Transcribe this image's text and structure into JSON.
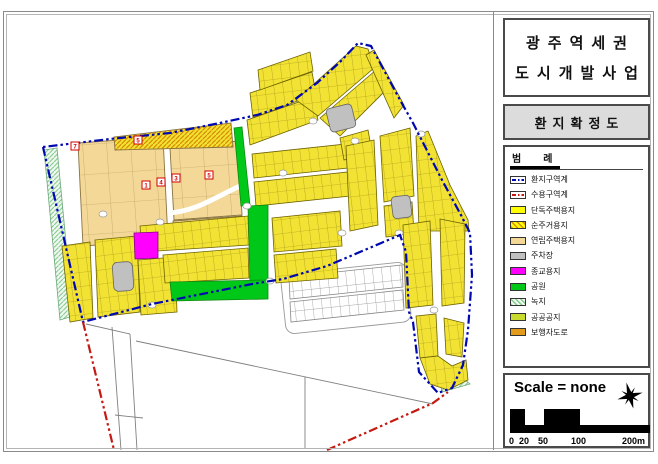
{
  "title_block": {
    "line1": "광주역세권",
    "line2": "도시개발사업"
  },
  "subtitle_block": {
    "label": "환지확정도"
  },
  "legend": {
    "title": "범례",
    "items": [
      {
        "label": "환지구역계",
        "type": "boundary-blue-dashdot"
      },
      {
        "label": "수용구역계",
        "type": "boundary-red-dashdot"
      },
      {
        "label": "단독주택용지",
        "type": "solid-yellow"
      },
      {
        "label": "순주거용지",
        "type": "yellow-orange-hatch"
      },
      {
        "label": "연립주택용지",
        "type": "solid-tan"
      },
      {
        "label": "주차장",
        "type": "solid-gray"
      },
      {
        "label": "종교용지",
        "type": "solid-magenta"
      },
      {
        "label": "공원",
        "type": "solid-green"
      },
      {
        "label": "녹지",
        "type": "green-hatch"
      },
      {
        "label": "공공공지",
        "type": "solid-yellowgreen"
      },
      {
        "label": "보행자도로",
        "type": "solid-orange"
      }
    ]
  },
  "scale_block": {
    "label": "Scale = none",
    "ticks": [
      "0",
      "20",
      "50",
      "100",
      "200m"
    ]
  },
  "map": {
    "badges": [
      "7",
      "5",
      "1",
      "4",
      "3",
      "5"
    ]
  },
  "colors": {
    "single_housing": "#FFFF00",
    "pure_residential_hatch": "#D88A00",
    "row_housing": "#F2D795",
    "parking": "#C0C0C0",
    "religious": "#FF00FF",
    "park": "#00C818",
    "greenbelt": "#E8F4EA",
    "public_open": "#C9DC2E",
    "pedestrian_road": "#E39B1B",
    "boundary_hwanji": "#0008B0",
    "boundary_suyong": "#C41A12"
  }
}
